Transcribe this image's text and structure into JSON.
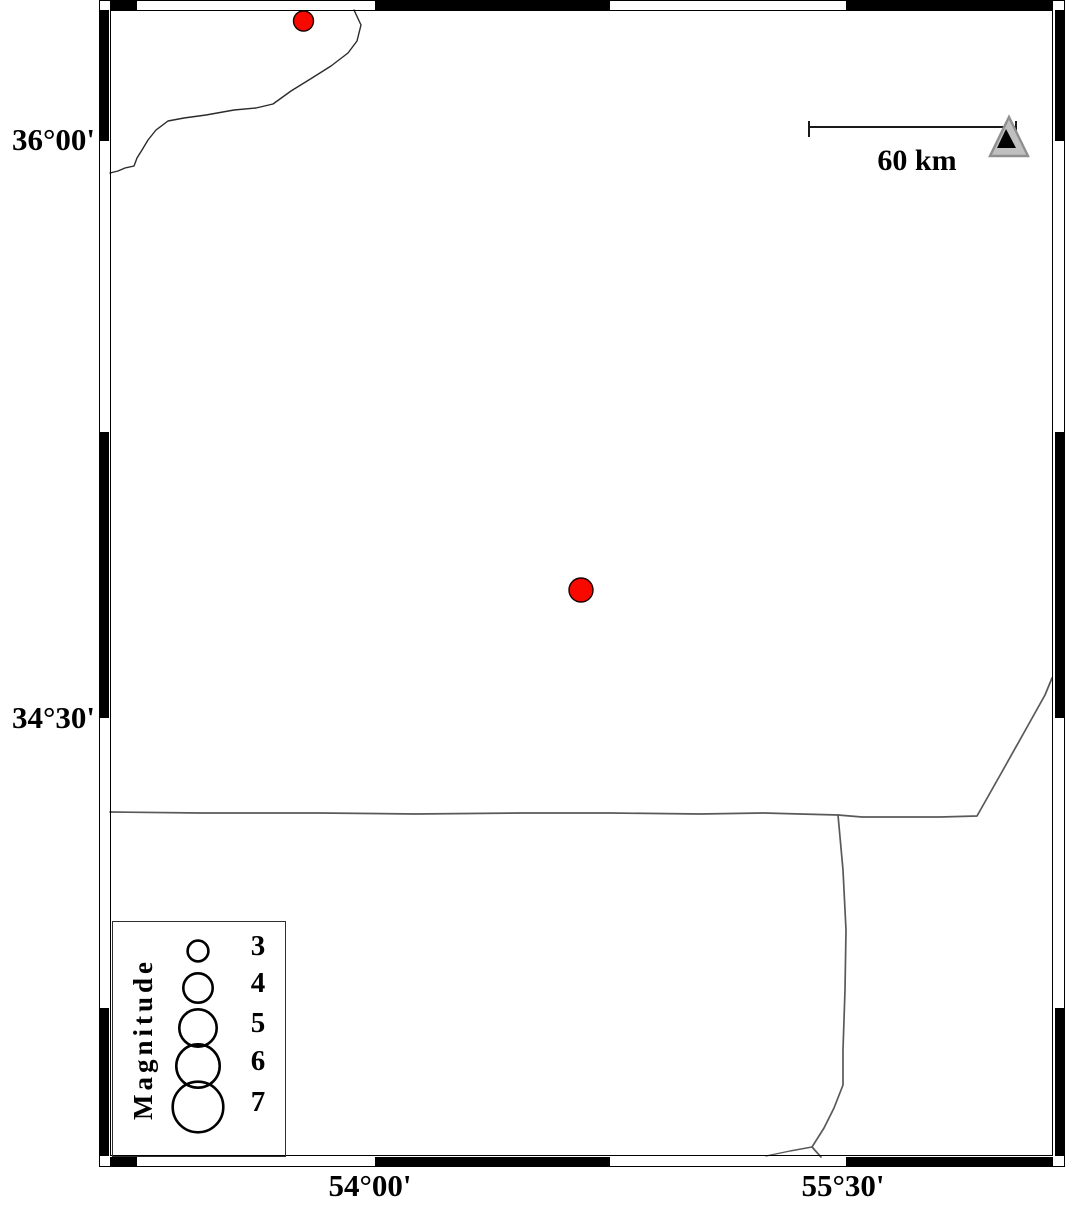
{
  "figure": {
    "kind": "seismicity-map",
    "background": "#ffffff"
  },
  "axes": {
    "left_labels": [
      {
        "text": "36°00'",
        "y": 140
      },
      {
        "text": "34°30'",
        "y": 718
      }
    ],
    "bottom_labels": [
      {
        "text": "54°00'",
        "x": 370
      },
      {
        "text": "55°30'",
        "x": 843
      }
    ]
  },
  "scale_bar": {
    "label": "60 km",
    "x1": 809,
    "x2": 1016,
    "y": 127,
    "tick_y1": 121,
    "tick_y2": 137,
    "color": "#1a1a1a"
  },
  "station_marker": {
    "shape": "triangle",
    "outer_points": "1009,117 990,156 1028,156",
    "inner_points": "1006,129 997,148 1016,148",
    "fill": "#c0c0c0",
    "stroke": "#8f8f8f",
    "inner_fill": "#000000"
  },
  "earthquakes": {
    "color": "#f70900",
    "outline": "#1a0000",
    "points": [
      {
        "cx": 303.5,
        "cy": 21,
        "r": 10
      },
      {
        "cx": 581,
        "cy": 590,
        "r": 12
      }
    ]
  },
  "legend": {
    "title": "Magnitude",
    "circle_color": "#000000",
    "entries": [
      {
        "label": "3",
        "cx": 198,
        "cy": 951,
        "r": 10.4
      },
      {
        "label": "4",
        "cx": 198,
        "cy": 988,
        "r": 14.7
      },
      {
        "label": "5",
        "cx": 198,
        "cy": 1028,
        "r": 18.7
      },
      {
        "label": "6",
        "cx": 198,
        "cy": 1066,
        "r": 21.7
      },
      {
        "label": "7",
        "cx": 198,
        "cy": 1107,
        "r": 25.3
      }
    ]
  },
  "map_lines": {
    "coastline_color": "#2b2b2b",
    "road_color": "#595959",
    "coastline": "354,10 361,25 357,41 348,53 331,66 312,78 291,91 273,104 256,108 234,110 206,115 184,118 168,121 156,130 148,140 142,150 137,158 134,166 125,168 118,171 110,173",
    "road_main": "110,812 200,813 320,813 415,814 520,813 610,813 700,814 764,813 800,814 838,815 862,817 905,817 940,817 977,816 1003,770 1026,729 1045,695 1052,678",
    "road_vertical": "838,815 843,870 846,930 845,990 843,1050 843,1085 834,1108 824,1128 812,1147 821,1157",
    "road_branch": "766,1156 790,1151 812,1147"
  }
}
